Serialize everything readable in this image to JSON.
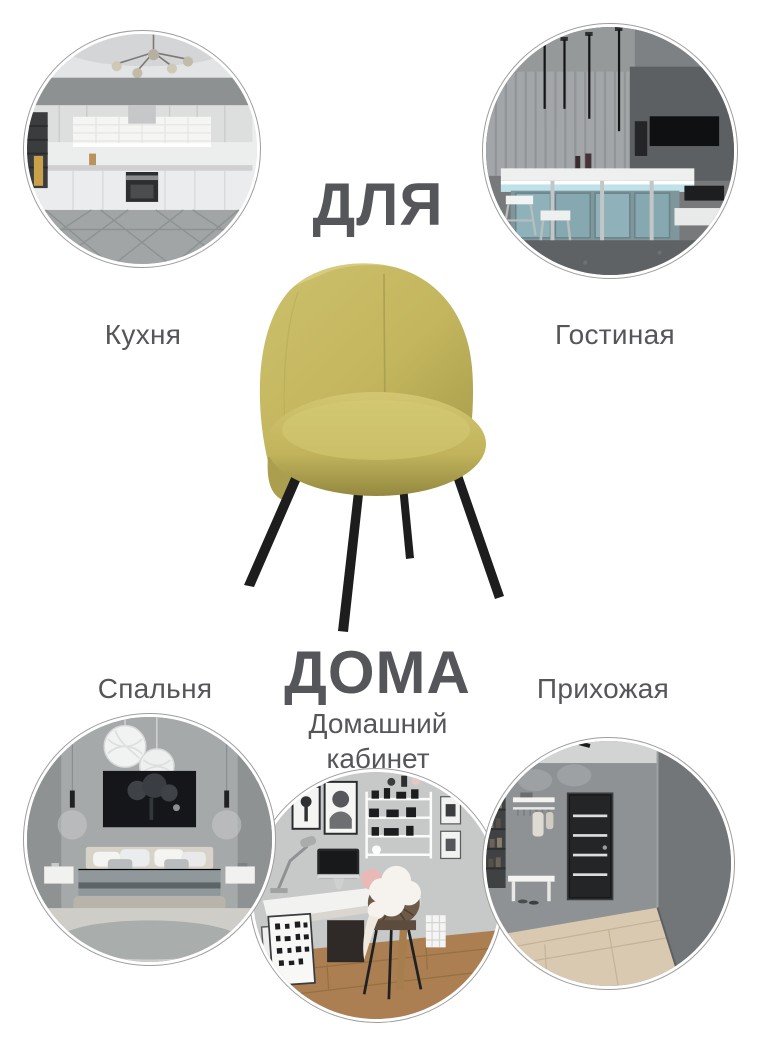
{
  "page": {
    "background_color": "#ffffff",
    "text_color": "#55565a"
  },
  "headline": {
    "word_top": "ДЛЯ",
    "word_bottom": "ДОМА"
  },
  "rooms": {
    "kitchen": {
      "label": "Кухня"
    },
    "living_room": {
      "label": "Гостиная"
    },
    "bedroom": {
      "label": "Спальня"
    },
    "home_office": {
      "label": "Домашний кабинет"
    },
    "hallway": {
      "label": "Прихожая"
    }
  },
  "product": {
    "fabric_color": "#c3b65e",
    "fabric_highlight": "#d8cc7d",
    "fabric_shadow": "#9a8e43",
    "legs_color": "#1d1d1d"
  },
  "circle_ring_color": "#9e9e9e"
}
